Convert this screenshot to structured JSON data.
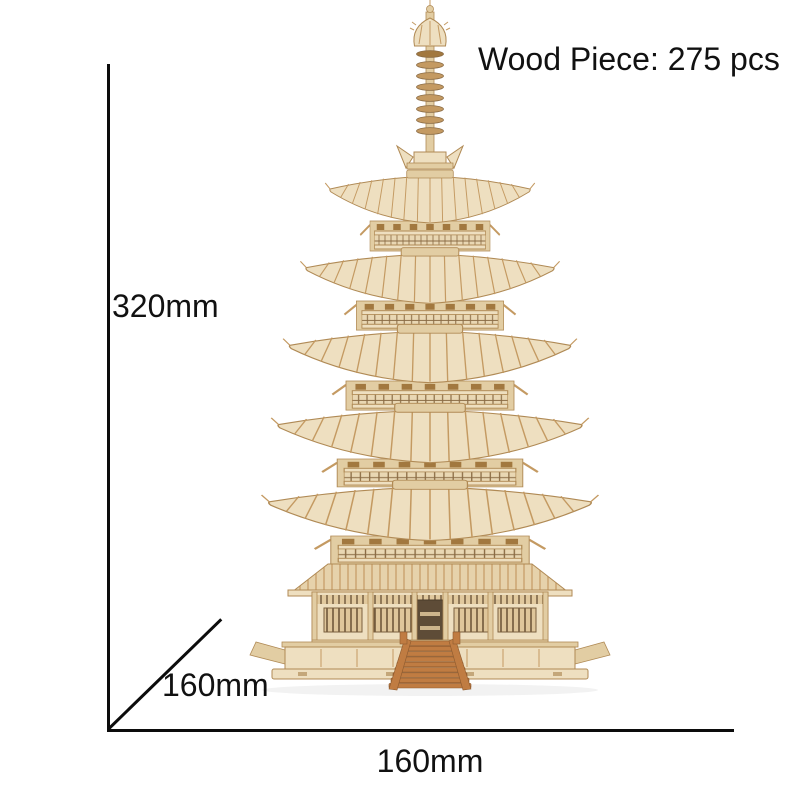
{
  "annotations": {
    "pieces": "Wood Piece: 275 pcs",
    "height": "320mm",
    "depth": "160mm",
    "width": "160mm"
  },
  "colors": {
    "background": "#ffffff",
    "dimension_line": "#0c0c0c",
    "label_text": "#111111",
    "wood_light": "#eedfc0",
    "wood_mid": "#e2cda3",
    "wood_rib": "#c49a62",
    "wood_dark": "#a2783f",
    "wood_deep": "#6d5438",
    "wood_outline": "#b08a55",
    "stair": "#c07c42"
  }
}
